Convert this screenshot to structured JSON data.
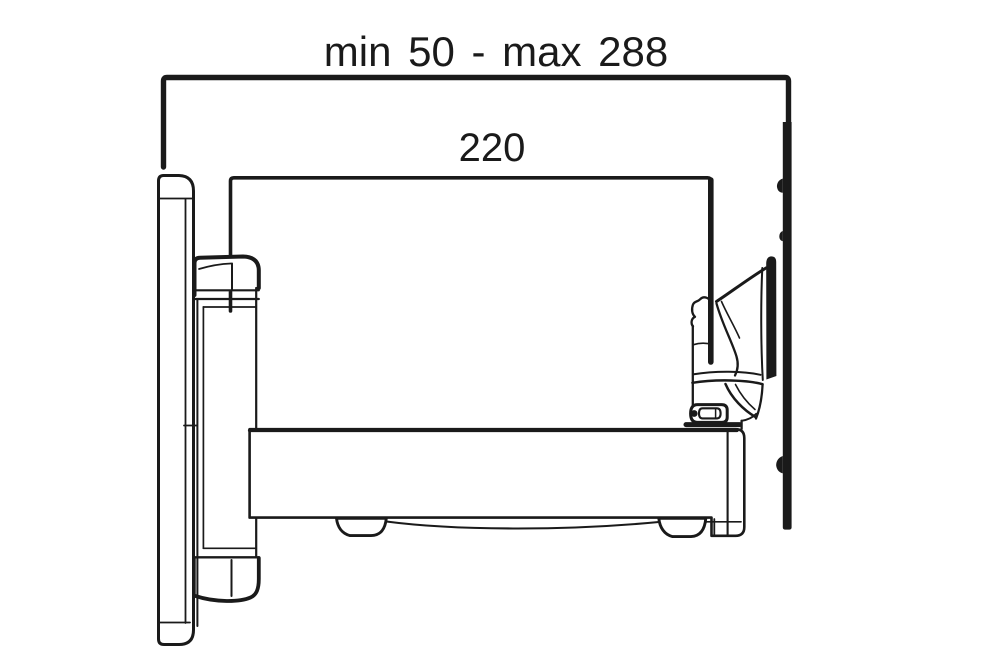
{
  "colors": {
    "ink": "#1a1a1a",
    "background": "#ffffff"
  },
  "dimensions": {
    "overall": {
      "label": "min 50 - max 288",
      "min": 50,
      "max": 288
    },
    "arm": {
      "label": "220",
      "value": 220
    }
  }
}
